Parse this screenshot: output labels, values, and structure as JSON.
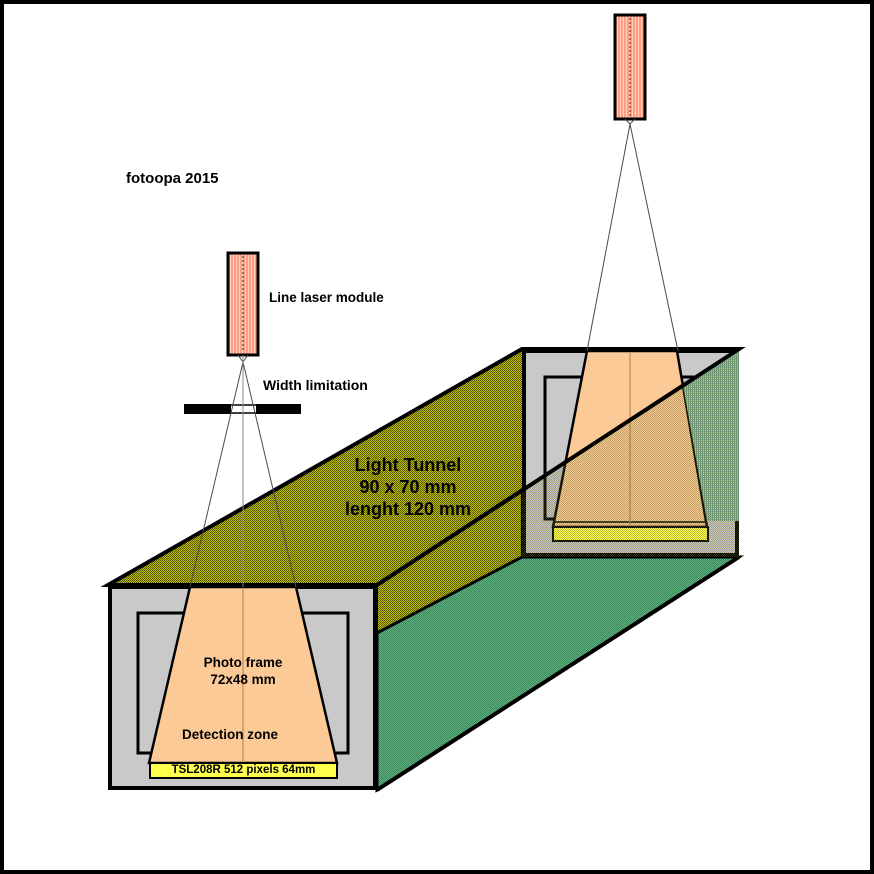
{
  "diagram": {
    "credit": "fotoopa 2015",
    "labels": {
      "line_laser_module": "Line laser module",
      "width_limitation": "Width limitation",
      "light_tunnel": [
        "Light Tunnel",
        "90 x 70 mm",
        "lenght 120 mm"
      ],
      "photo_frame": [
        "Photo frame",
        "72x48 mm"
      ],
      "detection_zone": "Detection zone",
      "sensor_front": "TSL208R 512 pixels 64mm"
    },
    "colors": {
      "background": "#FFFFFF",
      "outline": "#000000",
      "tunnel_top_olive": "#8B8B00",
      "tunnel_side_green": "#4E9C6E",
      "face_gray": "#C9C9C9",
      "beam_orange": "#FBCA97",
      "beam_center_line": "#C08850",
      "sensor_yellow": "#FFFF4D",
      "laser_body_salmon": "#FF9E82",
      "laser_stripe_light": "#FFD2BE",
      "interior_teal": "#6F9E86"
    }
  }
}
